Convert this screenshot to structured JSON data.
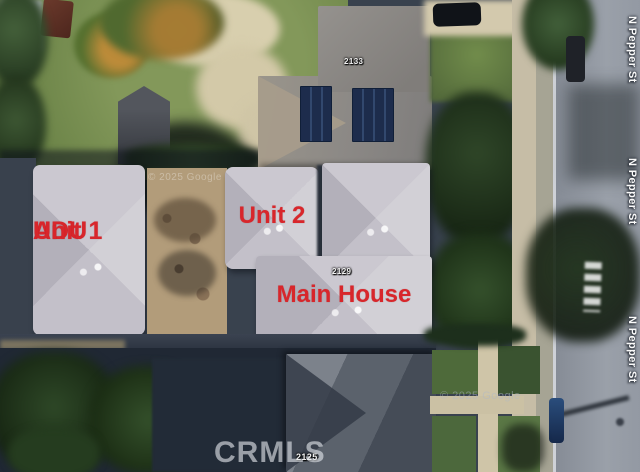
{
  "photo": {
    "description": "Aerial satellite view of residential property with unit annotations",
    "annotations": {
      "unit1_line1": "ADU",
      "unit1_line2": "Unit 1",
      "unit2": "Unit 2",
      "main_house": "Main House"
    },
    "map_labels": {
      "streets": [
        "N Pepper St",
        "N Pepper St",
        "N Pepper St"
      ],
      "addresses": [
        "2133",
        "2129",
        "2125"
      ]
    },
    "watermarks": {
      "mls": "CRMLS",
      "imagery": "© 2025 Google",
      "imagery2": "© 2025 Google"
    },
    "colors": {
      "annotation_red": "#d8262b",
      "roof_light_gray": "#c6c3cb",
      "street_asphalt": "#8f959f",
      "lawn_green": "#6f8a4c",
      "dirt_tan": "#b29c7a",
      "street_label_white": "#fafafa"
    }
  }
}
